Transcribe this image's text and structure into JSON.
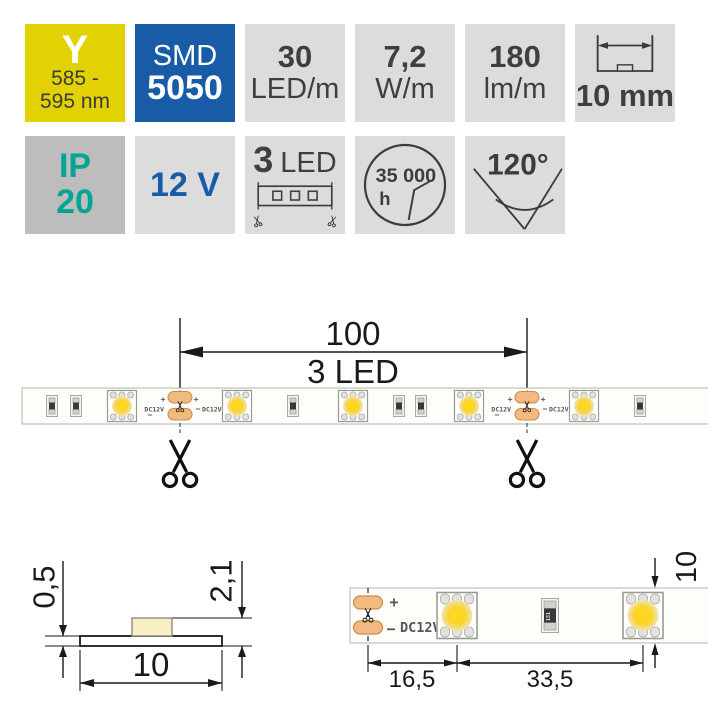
{
  "badges": {
    "row1": [
      {
        "name": "color-code",
        "label": "Y",
        "wavelength_line1": "585 -",
        "wavelength_line2": "595 nm"
      },
      {
        "name": "chip-type",
        "line1": "SMD",
        "line2": "5050"
      },
      {
        "name": "led-density",
        "value": "30",
        "unit": "LED/m"
      },
      {
        "name": "power",
        "value": "7,2",
        "unit": "W/m"
      },
      {
        "name": "luminous-flux",
        "value": "180",
        "unit": "lm/m"
      },
      {
        "name": "strip-width",
        "value": "10 mm"
      }
    ],
    "row2": [
      {
        "name": "ip-rating",
        "line1": "IP",
        "line2": "20"
      },
      {
        "name": "voltage",
        "value": "12 V"
      },
      {
        "name": "cut-unit",
        "value": "3",
        "unit": "LED"
      },
      {
        "name": "lifetime",
        "value": "35 000",
        "unit": "h"
      },
      {
        "name": "beam-angle",
        "value": "120°"
      }
    ]
  },
  "length_diagram": {
    "dim_length": "100",
    "dim_label": "3 LED",
    "plus": "+",
    "minus": "−",
    "dc_marking": "DC12V",
    "led_centers": [
      122,
      237,
      353,
      469,
      584
    ],
    "resistor_centers": [
      52,
      76,
      293,
      399,
      421,
      640
    ],
    "cut_centers": [
      180,
      527
    ]
  },
  "cross_section": {
    "dim_thickness": "0,5",
    "dim_height": "2,1",
    "dim_width": "10"
  },
  "detail_view": {
    "dim_cut_to_led": "16,5",
    "dim_led_spacing": "33,5",
    "dim_width": "10",
    "plus": "+",
    "minus": "−",
    "dc_marking": "DC12V",
    "resistor_code": "151",
    "led_centers": [
      457,
      643
    ],
    "resistor_centers": [
      550
    ],
    "cut_x": 368
  },
  "colors": {
    "badge_bg": "#dcdcdc",
    "badge_bg_dark": "#bdbdbd",
    "yellow": "#e2d103",
    "blue": "#185ba7",
    "teal": "#00a693",
    "badge_text": "#3f3f3f",
    "line": "#1a1a1a",
    "strip_fill": "#fdfdfa",
    "strip_border": "#c6c6c0",
    "led_border": "#9a9a94",
    "pad_fill": "#f1bb7f",
    "pad_border": "#cd8a4d",
    "marking": "#55555c",
    "cream": "#f8f0c2"
  }
}
